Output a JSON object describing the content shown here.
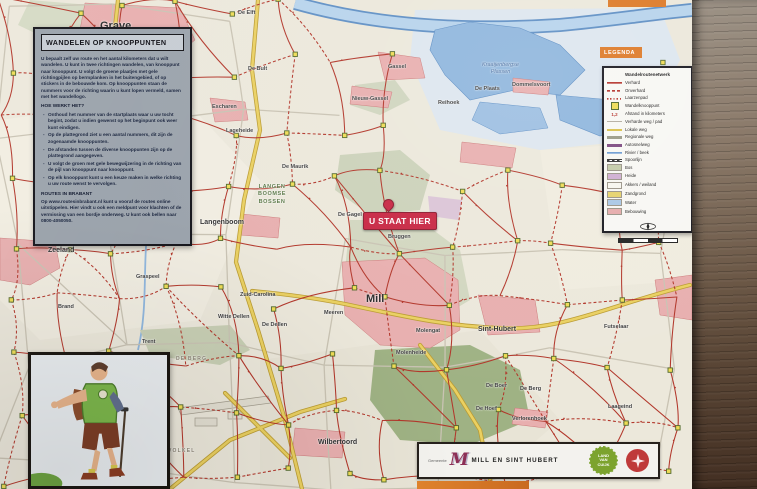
{
  "info_panel": {
    "title": "WANDELEN OP KNOOPPUNTEN",
    "intro": "U bepaalt zelf uw route en het aantal kilometers dat u wilt wandelen. U kunt in twee richtingen wandelen, van knooppunt naar knooppunt. U volgt de groene plaatjes met gele richtingpijlen op bermplanken in het buitengebied, of op stickers in de bebouwde kom. Op knooppunten staan de nummers voor de richting waarin u kunt lopen vermeld, samen met het wandellogo.",
    "how_title": "HOE WERKT HET?",
    "how_items": [
      "Onthoud het nummer van de startplaats waar u uw tocht begint, zodat u indien gewenst op het beginpunt ook weer kunt eindigen.",
      "Op de plattegrond ziet u een aantal nummers, dit zijn de zogenaamde knooppunten.",
      "De afstanden tussen de diverse knooppunten zijn op de plattegrond aangegeven.",
      "U volgt de groen met gele bewegwijzering in de richting van de pijl van knooppunt naar knooppunt.",
      "Op elk knooppunt kunt u een keuze maken in welke richting u uw route wenst te vervolgen."
    ],
    "routes_title": "ROUTES IN BRABANT",
    "routes_text": "Op www.routesinbrabant.nl kunt u vooraf de routes online uitstippelen. Hier vindt u ook een meldpunt voor klachten of de vermissing van een bordje onderweg. U kunt ook bellen naar 0800-4050050."
  },
  "legend": {
    "tab": "LEGENDA",
    "header": "Wandelroutenetwerk",
    "items": [
      {
        "swatch": "red",
        "label": "Verhard"
      },
      {
        "swatch": "red-dash",
        "label": "Onverhard"
      },
      {
        "swatch": "red-dot",
        "label": "Laarzenpad"
      },
      {
        "swatch": "knoop",
        "label": "Wandelknooppunt"
      },
      {
        "swatch": "dist",
        "mark": "1,2",
        "label": "Afstand in kilometers"
      },
      {
        "swatch": "grey",
        "label": "Verharde weg / pad"
      },
      {
        "swatch": "local",
        "label": "Lokale weg"
      },
      {
        "swatch": "regional",
        "label": "Regionale weg"
      },
      {
        "swatch": "motorway",
        "label": "Autosnelweg"
      },
      {
        "swatch": "river",
        "label": "Rivier / beek"
      },
      {
        "swatch": "rail",
        "label": "Spoorlijn"
      },
      {
        "swatch": "bos",
        "fill": true,
        "label": "Bos"
      },
      {
        "swatch": "heide",
        "fill": true,
        "label": "Heide"
      },
      {
        "swatch": "akkers",
        "fill": true,
        "label": "Akkers / weiland"
      },
      {
        "swatch": "zand",
        "fill": true,
        "label": "Zandgrond"
      },
      {
        "swatch": "water",
        "fill": true,
        "label": "Water"
      },
      {
        "swatch": "bebouwing",
        "fill": true,
        "label": "Bebouwing"
      }
    ]
  },
  "marker": {
    "label": "U STAAT HIER"
  },
  "map": {
    "labels": [
      {
        "name": "Grave",
        "x": 100,
        "y": 20,
        "k": "big"
      },
      {
        "name": "Escharen",
        "x": 212,
        "y": 104,
        "k": "town-s"
      },
      {
        "name": "De Elft",
        "x": 238,
        "y": 10,
        "k": "town-s"
      },
      {
        "name": "De Bult",
        "x": 248,
        "y": 66,
        "k": "town-s"
      },
      {
        "name": "Gassel",
        "x": 388,
        "y": 64,
        "k": "town-s"
      },
      {
        "name": "Nieuw-Gassel",
        "x": 352,
        "y": 96,
        "k": "town-s"
      },
      {
        "name": "Reihoek",
        "x": 438,
        "y": 100,
        "k": "town-s"
      },
      {
        "name": "De Plaats",
        "x": 475,
        "y": 86,
        "k": "town-s"
      },
      {
        "name": "Dommelsvoort",
        "x": 512,
        "y": 82,
        "k": "town-s"
      },
      {
        "name": "Kraaijenbergse\nPlassen",
        "x": 482,
        "y": 62,
        "k": "water"
      },
      {
        "name": "Lageheide",
        "x": 226,
        "y": 128,
        "k": "town-s"
      },
      {
        "name": "Elfkens",
        "x": 130,
        "y": 148,
        "k": "town-s"
      },
      {
        "name": "De Maurik",
        "x": 282,
        "y": 164,
        "k": "town-s"
      },
      {
        "name": "LANGEN\nBOOMSE\nBOSSEN",
        "x": 258,
        "y": 184,
        "k": "area"
      },
      {
        "name": "Langenboom",
        "x": 200,
        "y": 219,
        "k": "town"
      },
      {
        "name": "De Gagel",
        "x": 338,
        "y": 212,
        "k": "town-s"
      },
      {
        "name": "Bruggen",
        "x": 388,
        "y": 234,
        "k": "town-s"
      },
      {
        "name": "Zeeland",
        "x": 48,
        "y": 247,
        "k": "town"
      },
      {
        "name": "Graspeel",
        "x": 136,
        "y": 274,
        "k": "town-s"
      },
      {
        "name": "Brand",
        "x": 58,
        "y": 304,
        "k": "town-s"
      },
      {
        "name": "Trent",
        "x": 142,
        "y": 339,
        "k": "town-s"
      },
      {
        "name": "Zuid-Carolina",
        "x": 240,
        "y": 292,
        "k": "town-s"
      },
      {
        "name": "Witte Dellen",
        "x": 218,
        "y": 314,
        "k": "town-s"
      },
      {
        "name": "De Dellen",
        "x": 262,
        "y": 322,
        "k": "town-s"
      },
      {
        "name": "DE BERG",
        "x": 176,
        "y": 356,
        "k": "caps"
      },
      {
        "name": "Mill",
        "x": 366,
        "y": 293,
        "k": "big"
      },
      {
        "name": "Meeren",
        "x": 324,
        "y": 310,
        "k": "town-s"
      },
      {
        "name": "Molengat",
        "x": 416,
        "y": 328,
        "k": "town-s"
      },
      {
        "name": "Molenheide",
        "x": 396,
        "y": 350,
        "k": "town-s"
      },
      {
        "name": "Sint-Hubert",
        "x": 478,
        "y": 326,
        "k": "town"
      },
      {
        "name": "Futselaar",
        "x": 604,
        "y": 324,
        "k": "town-s"
      },
      {
        "name": "De Boer",
        "x": 486,
        "y": 383,
        "k": "town-s"
      },
      {
        "name": "De Berg",
        "x": 520,
        "y": 386,
        "k": "town-s"
      },
      {
        "name": "De Hoef",
        "x": 476,
        "y": 406,
        "k": "town-s"
      },
      {
        "name": "Verlorenhoek",
        "x": 512,
        "y": 416,
        "k": "town-s"
      },
      {
        "name": "Laageind",
        "x": 608,
        "y": 404,
        "k": "town-s"
      },
      {
        "name": "Wilbertoord",
        "x": 318,
        "y": 439,
        "k": "town"
      },
      {
        "name": "VOLKEL",
        "x": 168,
        "y": 448,
        "k": "caps"
      }
    ]
  },
  "footer": {
    "gemeente_prefix": "Gemeente",
    "monogram": "M",
    "gemeente_name": "MILL EN SINT HUBERT",
    "badge_green": "LAND\nVAN\nCUIJK"
  }
}
